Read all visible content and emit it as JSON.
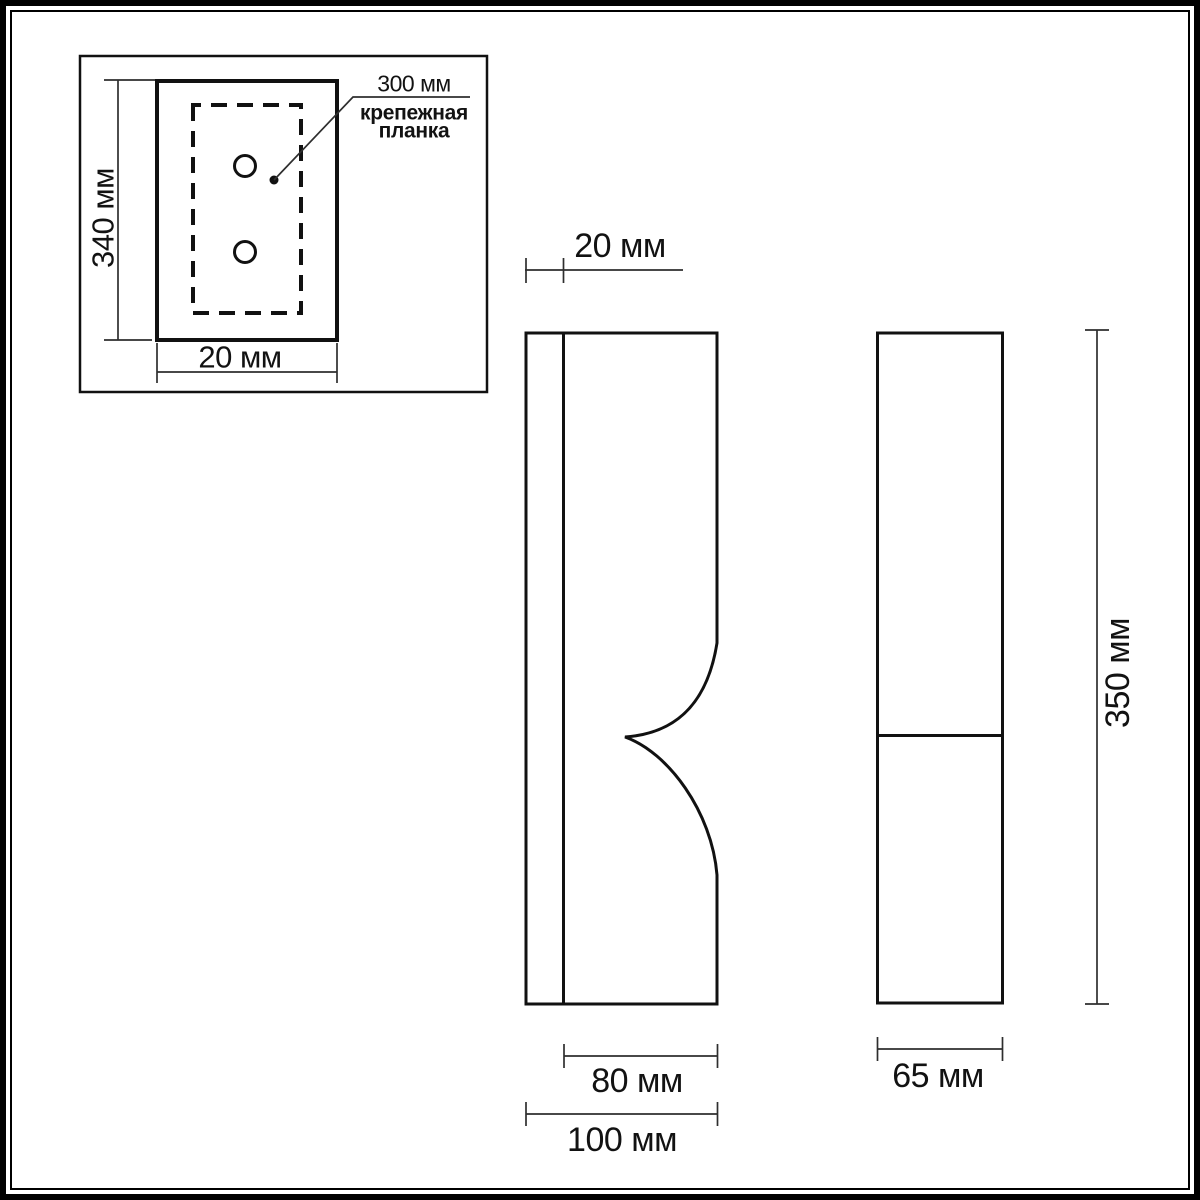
{
  "drawing": {
    "type": "dimensional-drawing",
    "units": "мм"
  },
  "colors": {
    "line": "#111111",
    "dimension_line": "#2e2e2e",
    "text": "#121212",
    "background": "#ffffff"
  },
  "inset": {
    "height_label": "340 мм",
    "width_label": "20 мм",
    "annotation_value": "300 мм",
    "annotation_caption_line1": "крепежная",
    "annotation_caption_line2": "планка"
  },
  "front_view": {
    "depth_label": "20 мм",
    "body_width_label": "80 мм",
    "overall_width_label": "100 мм"
  },
  "side_view": {
    "width_label": "65 мм",
    "height_label": "350 мм"
  }
}
